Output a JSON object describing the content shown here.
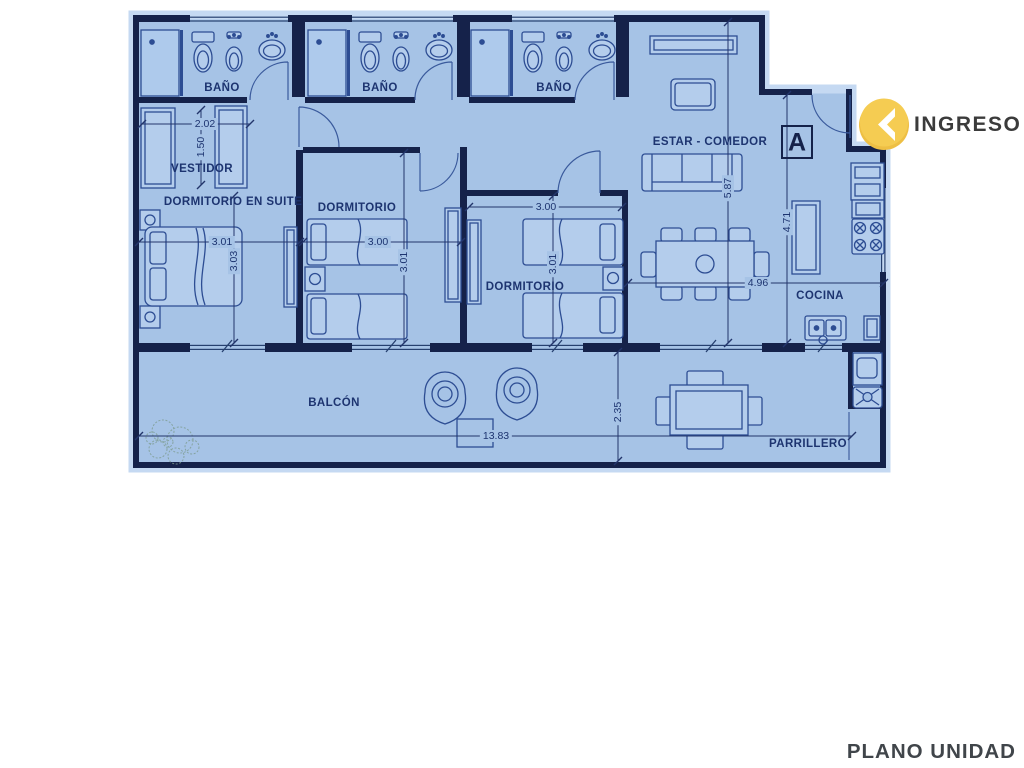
{
  "title": "PLANO UNIDAD",
  "entry": {
    "label": "INGRESO",
    "section_marker": "A",
    "icon": "chevron-left-in-yellow-circle"
  },
  "rooms": {
    "bathroom1": "BAÑO",
    "bathroom2": "BAÑO",
    "bathroom3": "BAÑO",
    "dressing": "VESTIDOR",
    "master": "DORMITORIO EN SUITE",
    "bedroom2": "DORMITORIO",
    "bedroom3": "DORMITORIO",
    "living": "ESTAR - COMEDOR",
    "kitchen": "COCINA",
    "balcony": "BALCÓN",
    "grill": "PARRILLERO"
  },
  "dimensions": {
    "dressing_width": "2.02",
    "dressing_depth": "1.50",
    "master_width": "3.01",
    "master_depth": "3.03",
    "bedroom2_width": "3.00",
    "bedroom2_depth": "3.01",
    "bedroom3_width": "3.00",
    "bedroom3_depth": "3.01",
    "living_depth": "5.87",
    "kitchen_depth": "4.71",
    "living_kitchen_width": "4.96",
    "balcony_width": "13.83",
    "balcony_depth": "2.35"
  },
  "colors": {
    "floor": "#a6c3e6",
    "halo": "#c5d9f2",
    "wall": "#15224a",
    "furniture_line": "#2d4d93",
    "furniture_fill": "#b4cdec",
    "dim_text": "#1d3470",
    "accent_yellow": "#f2c74b",
    "ingreso_text": "#3b3b3b",
    "footer_text": "#40454a"
  }
}
